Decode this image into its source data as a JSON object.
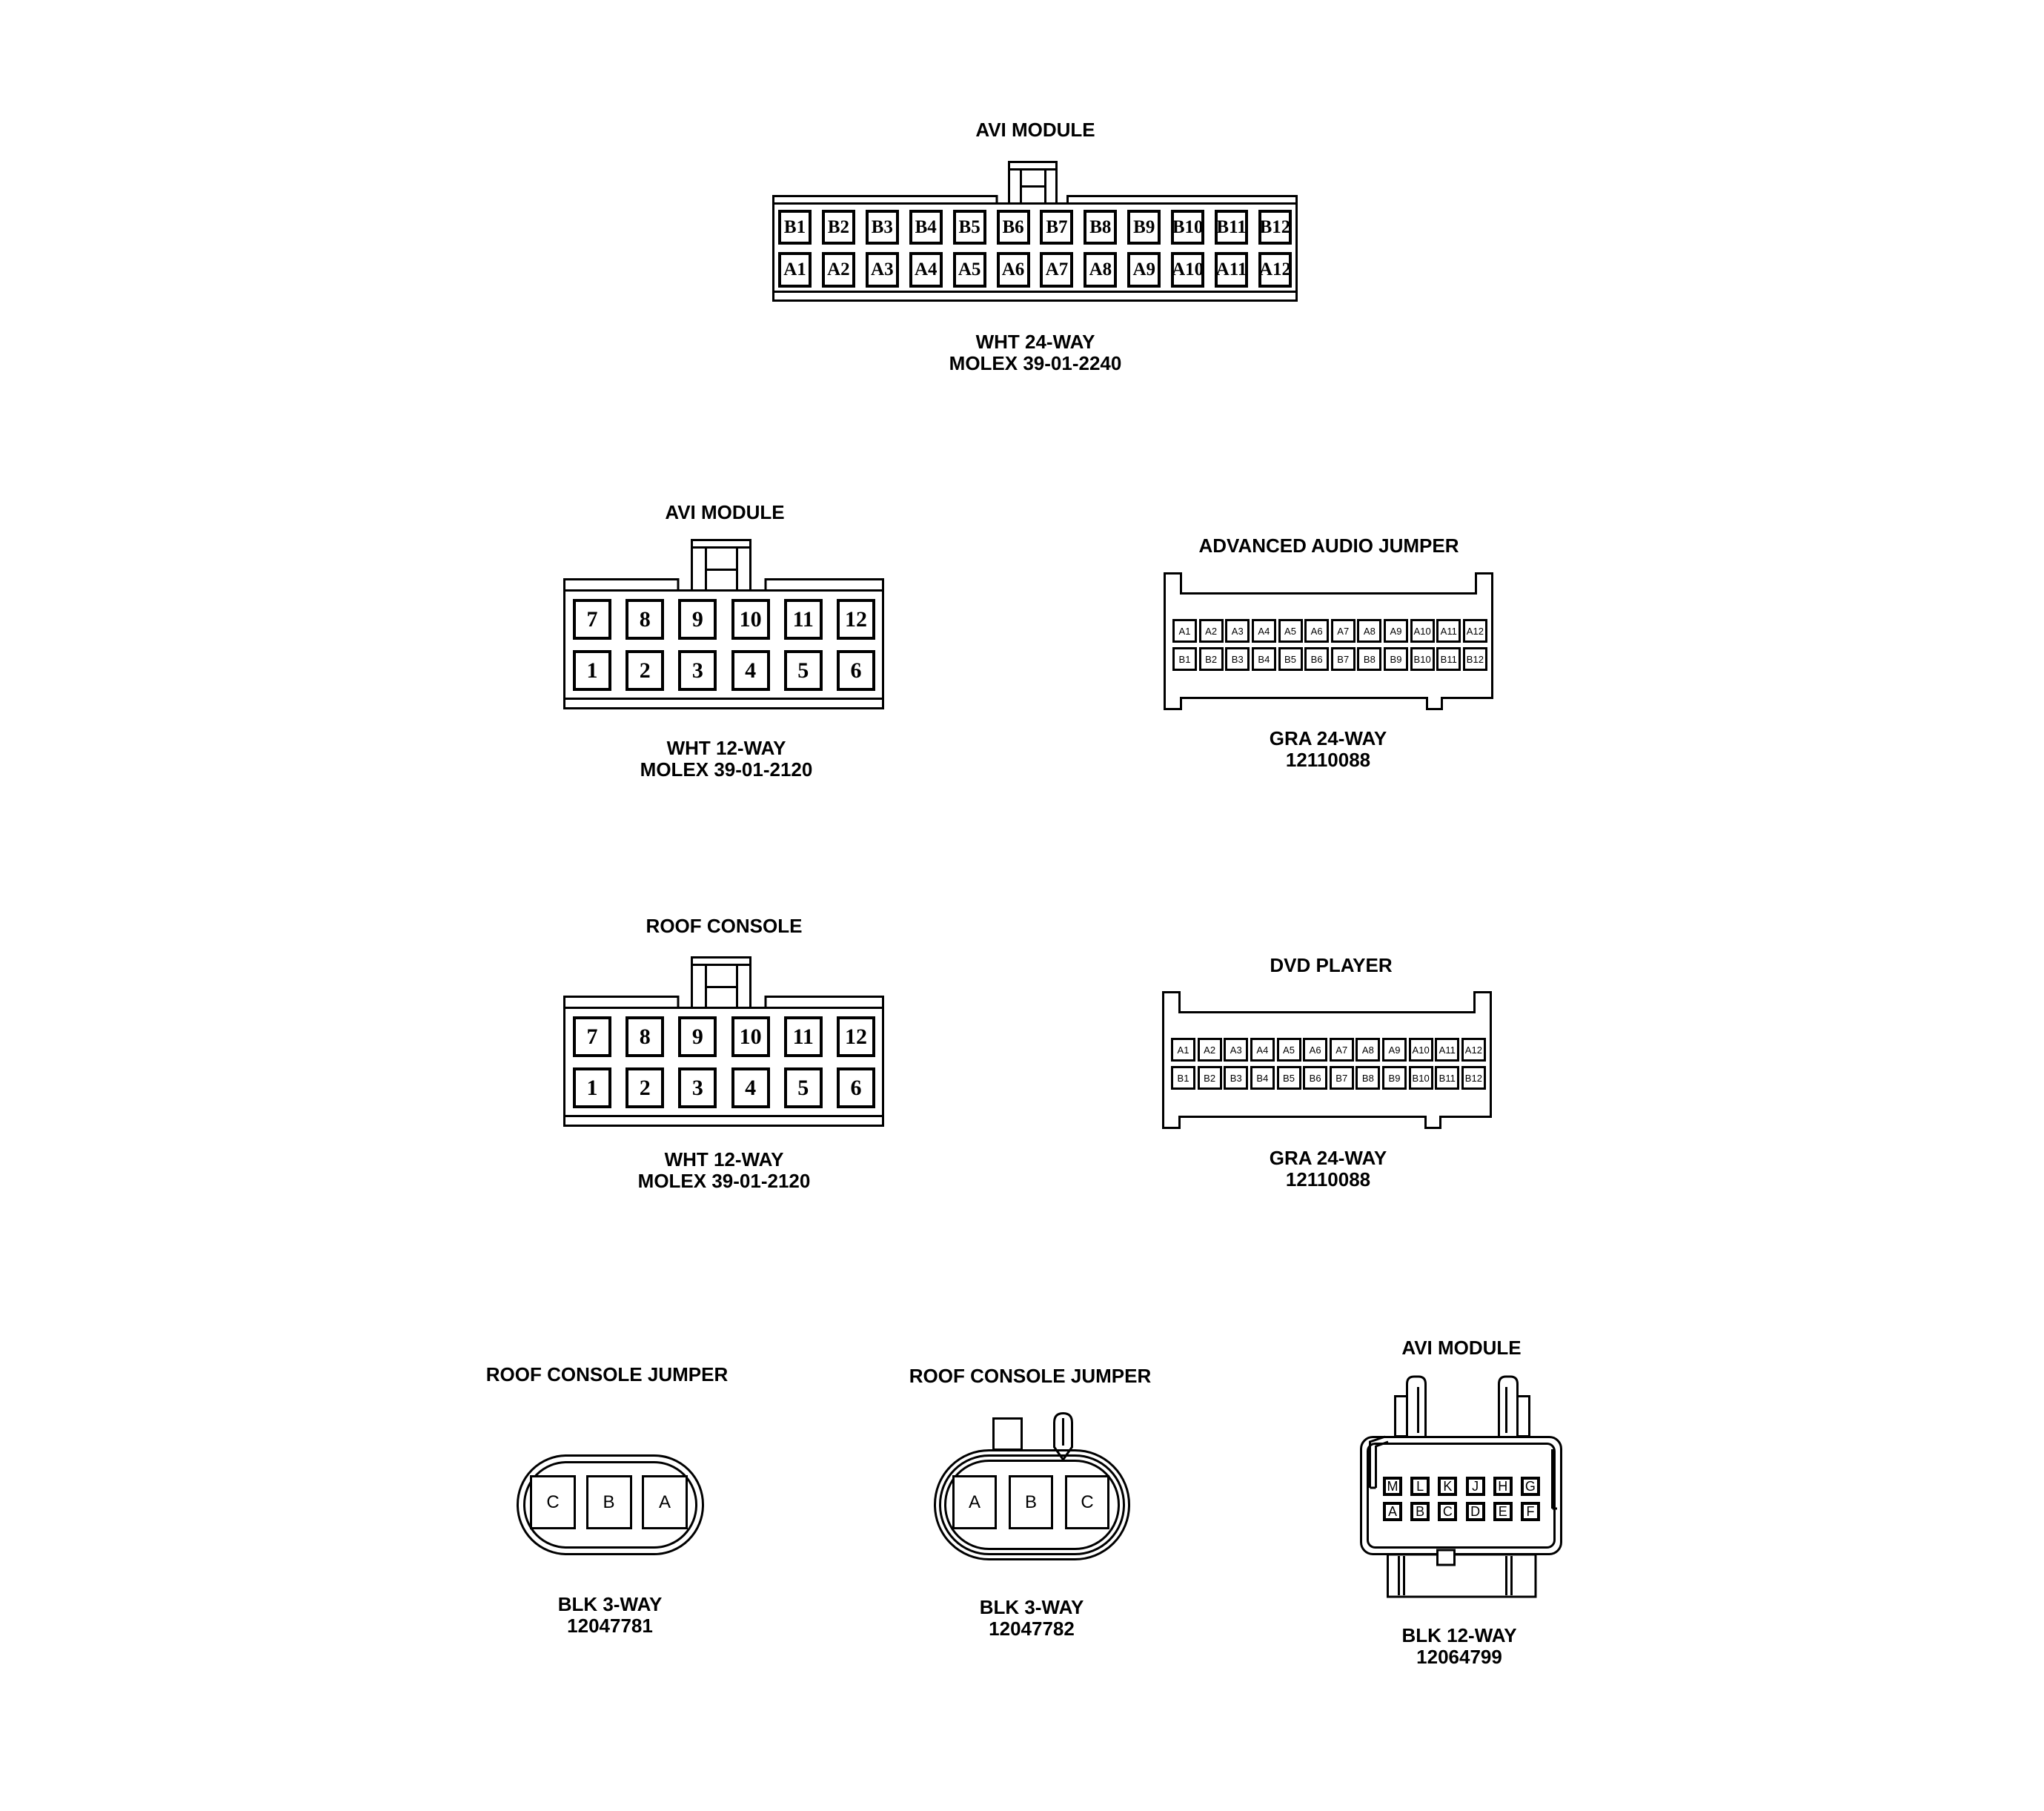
{
  "page": {
    "background_color": "#ffffff",
    "line_color": "#000000"
  },
  "connectors": [
    {
      "title": "AVI MODULE",
      "label_line1": "WHT 24-WAY",
      "label_line2": "MOLEX 39-01-2240",
      "pins_top": [
        "B1",
        "B2",
        "B3",
        "B4",
        "B5",
        "B6",
        "B7",
        "B8",
        "B9",
        "B10",
        "B11",
        "B12"
      ],
      "pins_bottom": [
        "A1",
        "A2",
        "A3",
        "A4",
        "A5",
        "A6",
        "A7",
        "A8",
        "A9",
        "A10",
        "A11",
        "A12"
      ]
    },
    {
      "title": "AVI MODULE",
      "label_line1": "WHT 12-WAY",
      "label_line2": "MOLEX 39-01-2120",
      "pins_top": [
        "7",
        "8",
        "9",
        "10",
        "11",
        "12"
      ],
      "pins_bottom": [
        "1",
        "2",
        "3",
        "4",
        "5",
        "6"
      ]
    },
    {
      "title": "ADVANCED AUDIO JUMPER",
      "label_line1": "GRA 24-WAY",
      "label_line2": "12110088",
      "pins_top": [
        "A1",
        "A2",
        "A3",
        "A4",
        "A5",
        "A6",
        "A7",
        "A8",
        "A9",
        "A10",
        "A11",
        "A12"
      ],
      "pins_bottom": [
        "B1",
        "B2",
        "B3",
        "B4",
        "B5",
        "B6",
        "B7",
        "B8",
        "B9",
        "B10",
        "B11",
        "B12"
      ]
    },
    {
      "title": "ROOF CONSOLE",
      "label_line1": "WHT 12-WAY",
      "label_line2": "MOLEX 39-01-2120",
      "pins_top": [
        "7",
        "8",
        "9",
        "10",
        "11",
        "12"
      ],
      "pins_bottom": [
        "1",
        "2",
        "3",
        "4",
        "5",
        "6"
      ]
    },
    {
      "title": "DVD PLAYER",
      "label_line1": "GRA 24-WAY",
      "label_line2": "12110088",
      "pins_top": [
        "A1",
        "A2",
        "A3",
        "A4",
        "A5",
        "A6",
        "A7",
        "A8",
        "A9",
        "A10",
        "A11",
        "A12"
      ],
      "pins_bottom": [
        "B1",
        "B2",
        "B3",
        "B4",
        "B5",
        "B6",
        "B7",
        "B8",
        "B9",
        "B10",
        "B11",
        "B12"
      ]
    },
    {
      "title": "ROOF CONSOLE JUMPER",
      "label_line1": "BLK 3-WAY",
      "label_line2": "12047781",
      "pins": [
        "C",
        "B",
        "A"
      ]
    },
    {
      "title": "ROOF CONSOLE JUMPER",
      "label_line1": "BLK 3-WAY",
      "label_line2": "12047782",
      "pins": [
        "A",
        "B",
        "C"
      ]
    },
    {
      "title": "AVI MODULE",
      "label_line1": "BLK 12-WAY",
      "label_line2": "12064799",
      "pins_top": [
        "M",
        "L",
        "K",
        "J",
        "H",
        "G"
      ],
      "pins_bottom": [
        "A",
        "B",
        "C",
        "D",
        "E",
        "F"
      ]
    }
  ]
}
